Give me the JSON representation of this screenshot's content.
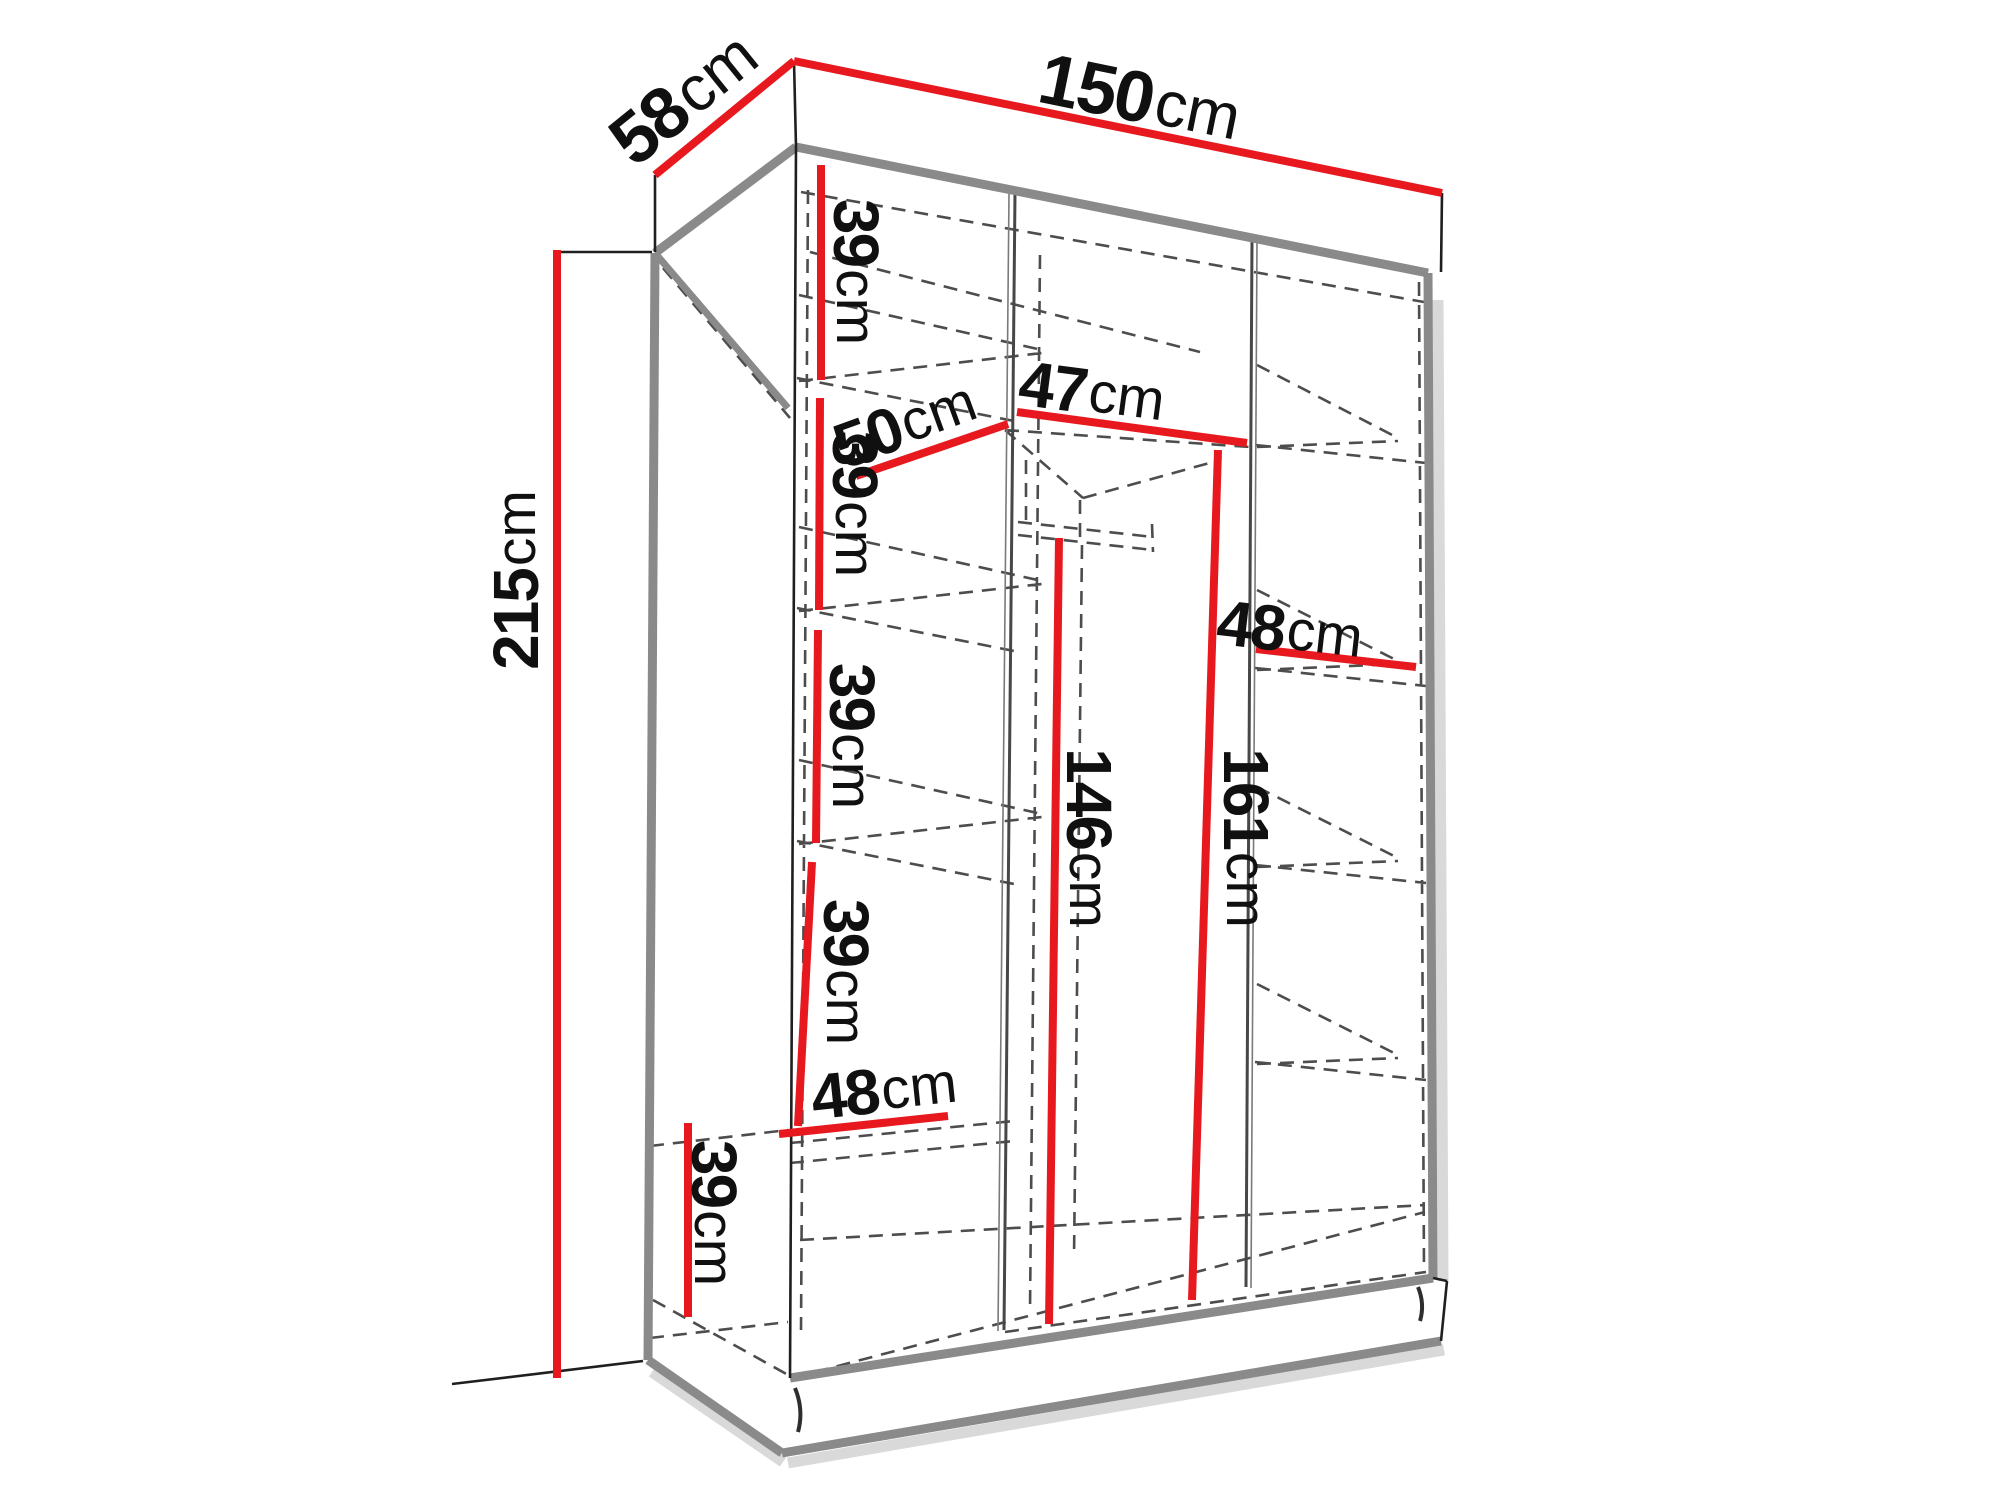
{
  "diagram": {
    "type": "furniture-dimension-diagram",
    "subject": "wardrobe interior dimensions, three sections with shelves and hanging rail",
    "unit": "cm",
    "colors": {
      "dimension_line": "#e7191e",
      "structure_edge": "#8a8a8a",
      "hidden_edge": "#4d4d4d",
      "label_text": "#101010",
      "background": "#ffffff"
    },
    "dimensions": [
      {
        "id": "total-width",
        "num": "150",
        "unit": "cm",
        "label": "150cm"
      },
      {
        "id": "total-depth",
        "num": "58",
        "unit": "cm",
        "label": "58cm"
      },
      {
        "id": "total-height",
        "num": "215",
        "unit": "cm",
        "label": "215cm"
      },
      {
        "id": "left-shelf-gap-1",
        "num": "39",
        "unit": "cm",
        "label": "39cm"
      },
      {
        "id": "left-shelf-gap-2",
        "num": "39",
        "unit": "cm",
        "label": "39cm"
      },
      {
        "id": "left-shelf-gap-3",
        "num": "39",
        "unit": "cm",
        "label": "39cm"
      },
      {
        "id": "left-shelf-gap-4",
        "num": "39",
        "unit": "cm",
        "label": "39cm"
      },
      {
        "id": "left-width-bottom",
        "num": "48",
        "unit": "cm",
        "label": "48cm"
      },
      {
        "id": "bottom-shelf-gap",
        "num": "39",
        "unit": "cm",
        "label": "39cm"
      },
      {
        "id": "left-width-top",
        "num": "50",
        "unit": "cm",
        "label": "50cm"
      },
      {
        "id": "middle-width",
        "num": "47",
        "unit": "cm",
        "label": "47cm"
      },
      {
        "id": "rail-height",
        "num": "146",
        "unit": "cm",
        "label": "146cm"
      },
      {
        "id": "middle-height",
        "num": "161",
        "unit": "cm",
        "label": "161cm"
      },
      {
        "id": "right-width",
        "num": "48",
        "unit": "cm",
        "label": "48cm"
      }
    ]
  }
}
